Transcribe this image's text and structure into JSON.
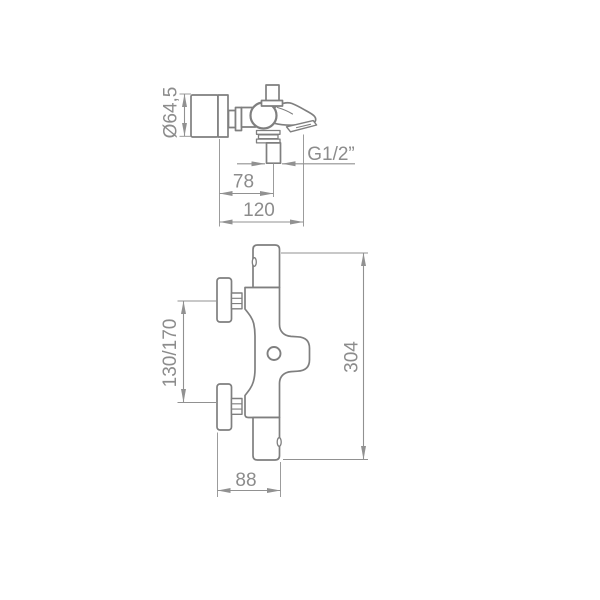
{
  "drawing": {
    "colors": {
      "background": "#ffffff",
      "outline": "#7f7f7f",
      "dimension_lines": "#919191",
      "text": "#8c8c8c"
    },
    "side_view": {
      "labels": {
        "diameter": "Ø64,5",
        "offset": "78",
        "projection": "120",
        "thread": "G1/2”"
      }
    },
    "front_view": {
      "labels": {
        "centers": "130/170",
        "height": "304",
        "depth": "88"
      }
    }
  }
}
